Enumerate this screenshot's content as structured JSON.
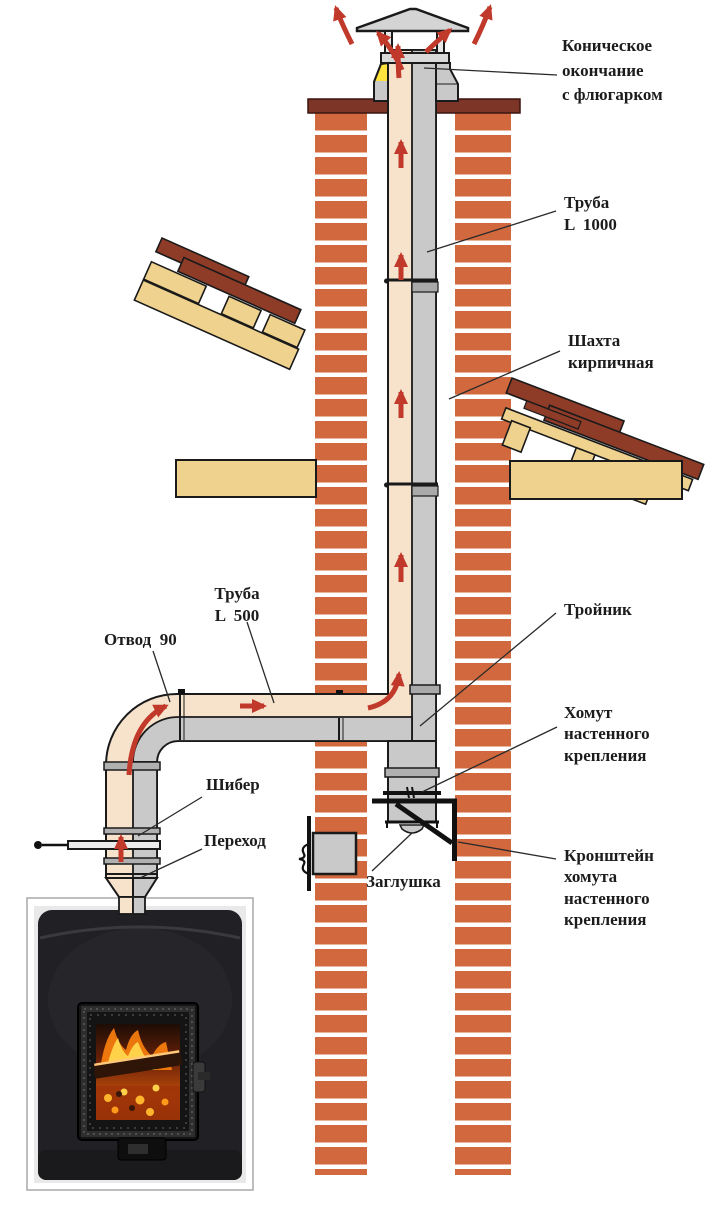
{
  "diagram": {
    "labels": {
      "cap": "Коническое\nокончание\nс флюгарком",
      "pipe_1000": "Труба\nL  1000",
      "shaft": "Шахта\nкирпичная",
      "pipe_500": "Труба\nL  500",
      "elbow": "Отвод  90",
      "tee": "Тройник",
      "wall_clamp": "Хомут\nнастенного\nкрепления",
      "damper": "Шибер",
      "adapter": "Переход",
      "plug": "Заглушка",
      "bracket": "Кронштейн\nхомута\nнастенного\nкрепления"
    },
    "palette": {
      "brick": "#d2693e",
      "mortar": "#ffffff",
      "roof_tile": "#8e3b28",
      "wood": "#f0d28f",
      "crown": "#7c3526",
      "pipe_light": "#f7e2cb",
      "pipe_shadow": "#c9c9c9",
      "joint_gray": "#a9a9a9",
      "flow_arrow": "#c0392b",
      "outline": "#1a1a1a",
      "cone_highlight": "#ffe23e"
    },
    "icons": {
      "flow_arrow": "red arrow showing flue-gas flow direction",
      "weathervane_cap": "conical rain cap with hat",
      "stove_fire_photo": "wood stove with burning fire behind glass door"
    }
  }
}
